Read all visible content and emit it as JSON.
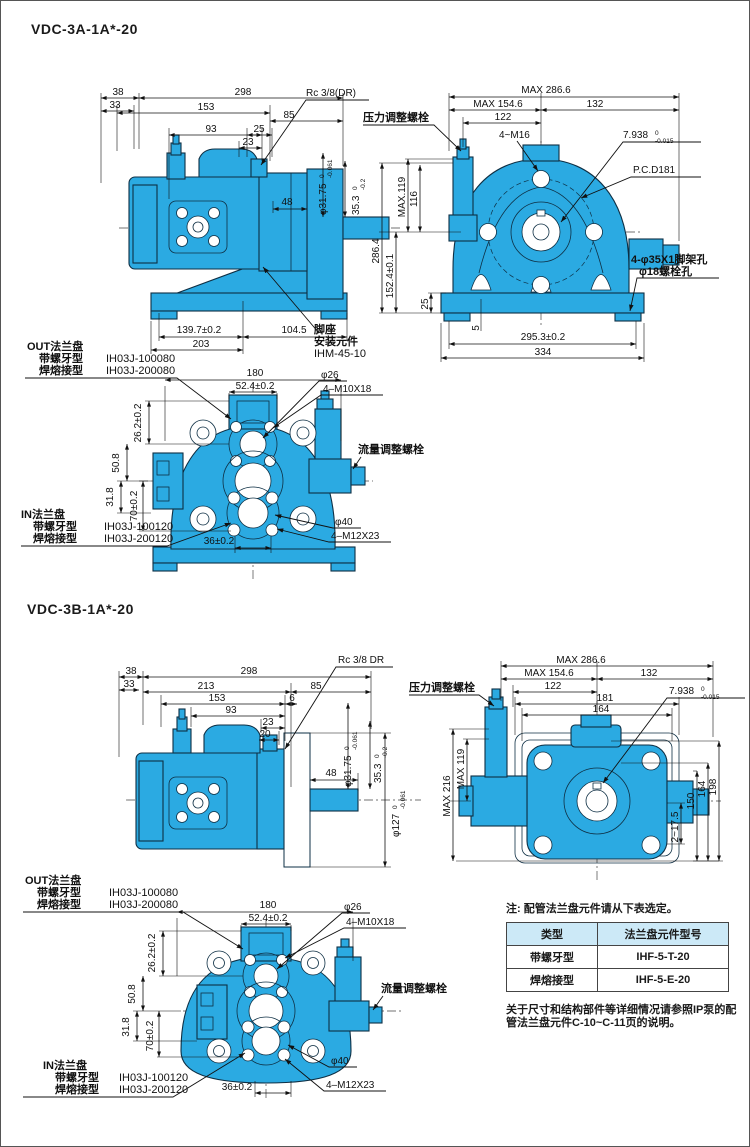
{
  "titles": {
    "section1": "VDC-3A-1A*-20",
    "section2": "VDC-3B-1A*-20"
  },
  "labels": {
    "pressure_bolt": "压力调整螺栓",
    "flow_bolt": "流量调整螺栓",
    "rc_a": "Rc 3/8(DR)",
    "rc_b": "Rc 3/8 DR",
    "foot1": "脚座",
    "foot2": "安装元件",
    "foot3": "IHM-45-10",
    "pcd": "P.C.D181",
    "m16": "4~M16",
    "frame_hole1": "4-φ35X1脚架孔",
    "frame_hole2": "φ18螺栓孔",
    "out_flange": "OUT法兰盘",
    "in_flange": "IN法兰盘",
    "threaded": "带螺牙型",
    "welded": "焊熔接型",
    "out_pn1": "IH03J-100080",
    "out_pn2": "IH03J-200080",
    "in_pn1": "IH03J-100120",
    "in_pn2": "IH03J-200120"
  },
  "dims": {
    "d38": "38",
    "d33": "33",
    "d298": "298",
    "d153": "153",
    "d85": "85",
    "d93": "93",
    "d25": "25",
    "d23": "23",
    "d213": "213",
    "d6": "6",
    "d20": "20",
    "d48": "48",
    "d3175": "φ31.75",
    "d353": "35.3",
    "d127": "φ127",
    "tol0": "0",
    "tolm061": "-0.061",
    "tolm02": "-0.2",
    "tolm015": "-0.015",
    "d7938": "7.938",
    "d1397": "139.7±0.2",
    "d1045": "104.5",
    "d203": "203",
    "max2866": "MAX 286.6",
    "max1546": "MAX 154.6",
    "d132": "132",
    "d122": "122",
    "max119a": "MAX.119",
    "d116": "116",
    "d2864": "286.4",
    "d1524": "152.4±0.1",
    "d25v": "25",
    "d5": "5",
    "d2953": "295.3±0.2",
    "d334": "334",
    "d180": "180",
    "d524": "52.4±0.2",
    "d26dia": "φ26",
    "m10": "4–M10X18",
    "d262": "26.2±0.2",
    "d508": "50.8",
    "d318": "31.8",
    "d70": "70±0.2",
    "d36": "36±0.2",
    "d40dia": "φ40",
    "m12": "4–M12X23",
    "d181": "181",
    "d164": "164",
    "max216": "MAX 216",
    "max119b": "MAX 119",
    "d2175": "2~17.5",
    "d150": "150",
    "d164v": "164",
    "d198": "198"
  },
  "note": {
    "heading": "注: 配管法兰盘元件请从下表选定。",
    "col_type": "类型",
    "col_pn": "法兰盘元件型号",
    "rows": [
      {
        "type": "带螺牙型",
        "pn": "IHF-5-T-20"
      },
      {
        "type": "焊熔接型",
        "pn": "IHF-5-E-20"
      }
    ],
    "footer1": "关于尺寸和结构部件等详细情况请参照IP泵的配",
    "footer2": "管法兰盘元件C-10~C-11页的说明。"
  }
}
